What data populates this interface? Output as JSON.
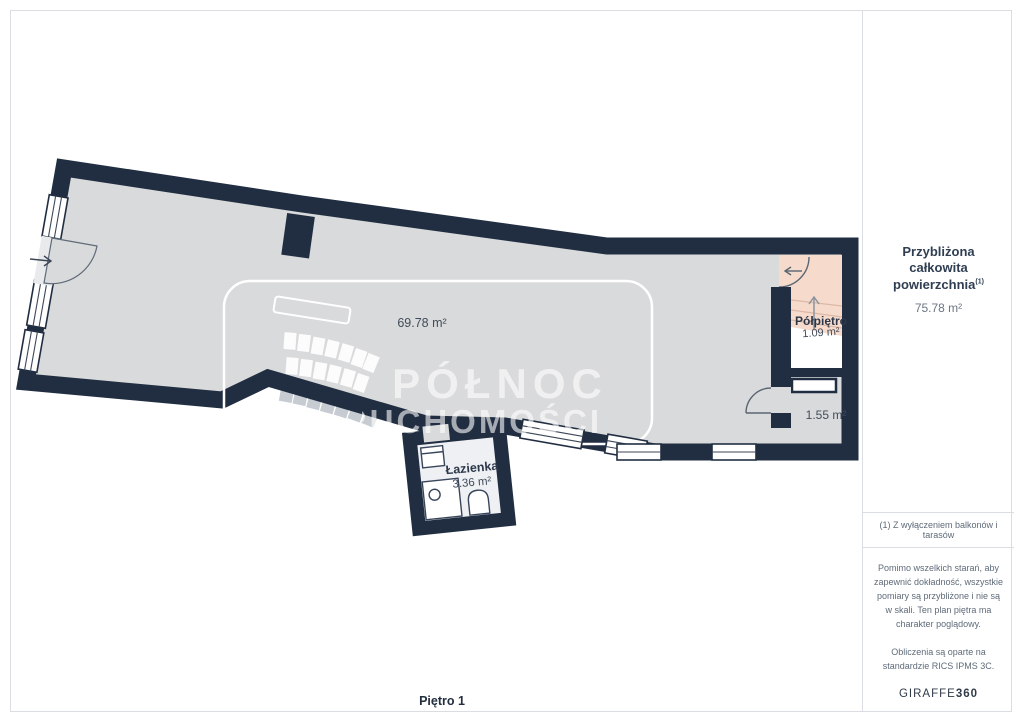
{
  "plan": {
    "floor_label": "Piętro 1",
    "watermark": {
      "line1": "PÓŁNOC",
      "line2": "NIERUCHOMOŚCI"
    },
    "rooms": {
      "main": {
        "area": "69.78 m²"
      },
      "bathroom": {
        "name": "Łazienka",
        "area": "3.36 m²"
      },
      "mezzanine": {
        "name": "Półpiętro",
        "area": "1.09 m²"
      },
      "small_room": {
        "area": "1.55 m²"
      }
    },
    "colors": {
      "wall": "#212e42",
      "floor": "#d9dadb",
      "mezzanine_fill": "#f6dbcc",
      "bathroom_floor": "#eef0f4",
      "exterior_step": "#c7ccd3"
    }
  },
  "sidebar": {
    "total_area_title_line1": "Przybliżona całkowita",
    "total_area_title_line2": "powierzchnia",
    "total_area_footnote_marker": "(1)",
    "total_area_value": "75.78 m²",
    "footnote": "(1) Z wyłączeniem balkonów i tarasów",
    "disclaimer": "Pomimo wszelkich starań, aby zapewnić dokładność, wszystkie pomiary są przybliżone i nie są w skali. Ten plan piętra ma charakter poglądowy.",
    "standard_note": "Obliczenia są oparte na standardzie RICS IPMS 3C.",
    "brand_name": "GIRAFFE",
    "brand_suffix": "360"
  }
}
